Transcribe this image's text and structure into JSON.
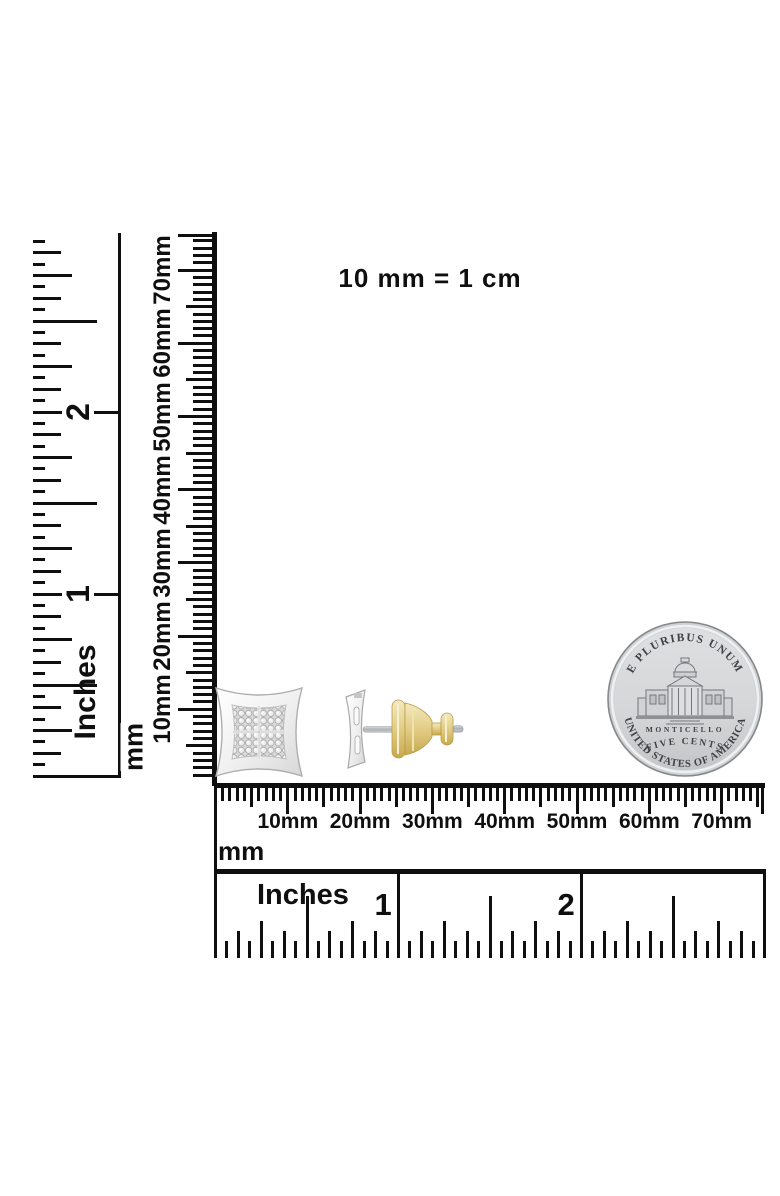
{
  "scale_note": "10 mm = 1 cm",
  "vertical_inches_ruler": {
    "unit_label": "Inches",
    "numbers": [
      "1",
      "2"
    ]
  },
  "vertical_mm_ruler": {
    "unit_label": "mm",
    "labels": [
      "10mm",
      "20mm",
      "30mm",
      "40mm",
      "50mm",
      "60mm",
      "70mm"
    ]
  },
  "horizontal_mm_ruler": {
    "unit_label": "mm",
    "labels": [
      "10mm",
      "20mm",
      "30mm",
      "40mm",
      "50mm",
      "60mm",
      "70mm"
    ]
  },
  "horizontal_inches_ruler": {
    "unit_label": "Inches",
    "numbers": [
      "1",
      "2"
    ]
  },
  "coin": {
    "top_motto": "E PLURIBUS UNUM",
    "building_name": "MONTICELLO",
    "denomination": "FIVE CENTS",
    "country": "UNITED STATES OF AMERICA"
  },
  "colors": {
    "ruler_ink": "#0f0f0f",
    "silver": "#e6e7e8",
    "gold": "#dcc375",
    "coin_face": "#d6d8da",
    "coin_text": "#3f4245"
  }
}
